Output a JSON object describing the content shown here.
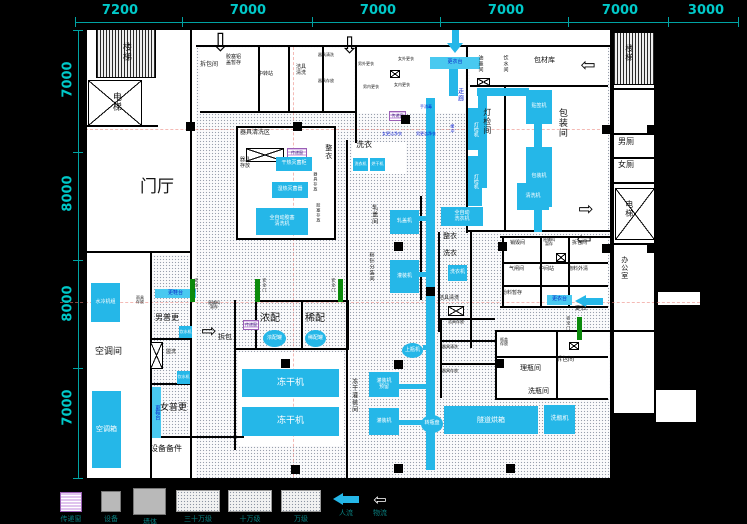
{
  "meta": {
    "app_title": "工厂洁净车间平面图",
    "drawing_type": "CAD floor plan"
  },
  "colors": {
    "background": "#000000",
    "plan": "#ffffff",
    "dimension_text": "#00c9c9",
    "equipment_fill": "#25b7e8",
    "clean_label_blue": "#0a1ed2",
    "safety_door_green": "#0b8a0b",
    "pass_window": "#e0c4ee",
    "legend_text": "#0a8080"
  },
  "dims": {
    "top": {
      "line": [
        75,
        22,
        663,
        1
      ],
      "ticks": [
        75,
        182,
        312,
        440,
        568,
        668,
        738
      ],
      "labels": [
        {
          "t": "7200",
          "x": 100
        },
        {
          "t": "7000",
          "x": 228
        },
        {
          "t": "7000",
          "x": 358
        },
        {
          "t": "7000",
          "x": 486
        },
        {
          "t": "7000",
          "x": 600
        },
        {
          "t": "3000",
          "x": 686
        }
      ]
    },
    "left": {
      "line": [
        78,
        30,
        1,
        448
      ],
      "ticks": [
        30,
        152,
        260,
        368,
        478
      ],
      "labels": [
        {
          "t": "7000",
          "y": 72
        },
        {
          "t": "8000",
          "y": 186
        },
        {
          "t": "8000",
          "y": 296
        },
        {
          "t": "7000",
          "y": 400
        }
      ]
    }
  },
  "whites": [
    [
      85,
      28,
      527,
      452
    ],
    [
      612,
      30,
      44,
      385
    ],
    [
      656,
      290,
      46,
      17
    ],
    [
      654,
      388,
      44,
      36
    ]
  ],
  "dotted": [
    [
      196,
      47,
      414,
      431
    ],
    [
      150,
      255,
      40,
      181
    ]
  ],
  "white_rooms": [
    [
      468,
      87,
      140,
      145
    ],
    [
      470,
      47,
      138,
      38
    ],
    [
      238,
      352,
      106,
      94
    ],
    [
      352,
      142,
      54,
      32
    ],
    [
      238,
      128,
      96,
      112
    ],
    [
      497,
      332,
      112,
      66
    ],
    [
      505,
      238,
      103,
      68
    ],
    [
      200,
      48,
      154,
      64
    ],
    [
      357,
      47,
      108,
      66
    ]
  ],
  "hatched": [
    [
      96,
      29,
      60,
      49
    ],
    [
      613,
      32,
      42,
      53
    ]
  ],
  "xboxes": [
    [
      88,
      80,
      54,
      46
    ],
    [
      615,
      188,
      40,
      52
    ],
    [
      246,
      148,
      38,
      14
    ],
    [
      448,
      306,
      16,
      10
    ],
    [
      477,
      78,
      13,
      8
    ],
    [
      150,
      342,
      13,
      27
    ],
    [
      556,
      253,
      10,
      9
    ],
    [
      390,
      70,
      10,
      8
    ],
    [
      569,
      342,
      10,
      8
    ]
  ],
  "walls": [
    [
      85,
      28,
      527,
      2
    ],
    [
      85,
      478,
      527,
      2
    ],
    [
      85,
      28,
      2,
      452
    ],
    [
      610,
      28,
      2,
      452
    ],
    [
      85,
      125,
      73,
      2
    ],
    [
      85,
      251,
      106,
      2
    ],
    [
      150,
      253,
      2,
      227
    ],
    [
      152,
      338,
      38,
      2
    ],
    [
      152,
      383,
      38,
      2
    ],
    [
      150,
      436,
      94,
      2
    ],
    [
      190,
      28,
      2,
      452
    ],
    [
      196,
      45,
      416,
      2
    ],
    [
      200,
      111,
      156,
      2
    ],
    [
      355,
      45,
      2,
      98
    ],
    [
      258,
      47,
      2,
      64
    ],
    [
      288,
      47,
      2,
      64
    ],
    [
      322,
      47,
      2,
      64
    ],
    [
      238,
      126,
      98,
      2
    ],
    [
      236,
      126,
      2,
      114
    ],
    [
      334,
      126,
      2,
      114
    ],
    [
      236,
      238,
      100,
      2
    ],
    [
      466,
      45,
      2,
      188
    ],
    [
      470,
      85,
      138,
      2
    ],
    [
      504,
      87,
      2,
      145
    ],
    [
      468,
      230,
      142,
      2
    ],
    [
      255,
      300,
      92,
      2
    ],
    [
      255,
      300,
      2,
      50
    ],
    [
      301,
      302,
      2,
      48
    ],
    [
      347,
      300,
      2,
      50
    ],
    [
      234,
      348,
      114,
      2
    ],
    [
      234,
      300,
      2,
      150
    ],
    [
      346,
      140,
      2,
      338
    ],
    [
      420,
      196,
      2,
      104
    ],
    [
      438,
      232,
      2,
      100
    ],
    [
      470,
      232,
      2,
      116
    ],
    [
      500,
      236,
      110,
      2
    ],
    [
      502,
      236,
      2,
      70
    ],
    [
      500,
      306,
      108,
      2
    ],
    [
      540,
      238,
      2,
      68
    ],
    [
      568,
      238,
      2,
      68
    ],
    [
      502,
      262,
      106,
      2
    ],
    [
      502,
      285,
      106,
      2
    ],
    [
      495,
      330,
      2,
      70
    ],
    [
      495,
      330,
      115,
      2
    ],
    [
      495,
      398,
      113,
      2
    ],
    [
      556,
      332,
      2,
      66
    ],
    [
      495,
      356,
      113,
      2
    ],
    [
      440,
      318,
      2,
      80
    ],
    [
      440,
      318,
      55,
      2
    ],
    [
      440,
      340,
      55,
      2
    ],
    [
      440,
      363,
      55,
      2
    ],
    [
      612,
      88,
      44,
      2
    ],
    [
      612,
      133,
      44,
      2
    ],
    [
      612,
      157,
      44,
      2
    ],
    [
      612,
      182,
      44,
      2
    ],
    [
      612,
      243,
      44,
      2
    ],
    [
      612,
      330,
      44,
      2
    ],
    [
      654,
      30,
      2,
      385
    ],
    [
      612,
      30,
      44,
      2
    ],
    [
      612,
      413,
      44,
      2
    ]
  ],
  "pipes": [
    [
      449,
      62,
      9,
      34
    ],
    [
      477,
      88,
      52,
      8
    ],
    [
      478,
      96,
      9,
      92
    ],
    [
      426,
      98,
      9,
      372
    ],
    [
      398,
      216,
      28,
      5
    ],
    [
      398,
      272,
      28,
      5
    ],
    [
      398,
      384,
      28,
      5
    ],
    [
      398,
      420,
      28,
      5
    ],
    [
      423,
      345,
      12,
      5
    ],
    [
      534,
      123,
      8,
      25
    ],
    [
      534,
      205,
      8,
      27
    ]
  ],
  "axes": [
    {
      "k": "h",
      "b": [
        85,
        129,
        525,
        0
      ]
    },
    {
      "k": "h",
      "b": [
        60,
        302,
        640,
        0
      ]
    },
    {
      "k": "v",
      "b": [
        293,
        47,
        0,
        430
      ]
    }
  ],
  "equipment": [
    {
      "t": "贴签机",
      "b": [
        526,
        90,
        26,
        34
      ]
    },
    {
      "t": "包装机",
      "b": [
        526,
        147,
        26,
        60
      ]
    },
    {
      "t": "更衣台",
      "b": [
        430,
        57,
        50,
        12
      ],
      "k": "light"
    },
    {
      "t": "干热灭菌柜",
      "b": [
        276,
        157,
        36,
        14
      ]
    },
    {
      "t": "湿热灭菌器",
      "b": [
        272,
        182,
        36,
        16
      ]
    },
    {
      "t": "全自动胶塞\n清洗机",
      "b": [
        256,
        208,
        52,
        27
      ]
    },
    {
      "t": "洗衣机",
      "b": [
        353,
        158,
        15,
        13
      ],
      "s": 4
    },
    {
      "t": "烘干机",
      "b": [
        370,
        158,
        15,
        13
      ],
      "s": 4
    },
    {
      "t": "清洗机",
      "b": [
        517,
        183,
        32,
        27
      ]
    },
    {
      "t": "全自动\n洗衣机",
      "b": [
        441,
        207,
        42,
        19
      ]
    },
    {
      "t": "洗衣机",
      "b": [
        448,
        265,
        19,
        16
      ]
    },
    {
      "t": "轧盖机",
      "b": [
        390,
        210,
        29,
        24
      ]
    },
    {
      "t": "灌装机",
      "b": [
        390,
        260,
        29,
        33
      ]
    },
    {
      "t": "冻干机",
      "b": [
        242,
        369,
        97,
        28
      ],
      "s": 9
    },
    {
      "t": "冻干机",
      "b": [
        242,
        407,
        97,
        29
      ],
      "s": 9
    },
    {
      "t": "浓配罐",
      "b": [
        263,
        330,
        23,
        17
      ],
      "k": "ellipse"
    },
    {
      "t": "稀配罐",
      "b": [
        305,
        330,
        21,
        17
      ],
      "k": "ellipse"
    },
    {
      "t": "灌装机\n预留",
      "b": [
        369,
        372,
        30,
        25
      ]
    },
    {
      "t": "灌装机",
      "b": [
        369,
        408,
        30,
        27
      ]
    },
    {
      "t": "上瓶机",
      "b": [
        402,
        343,
        21,
        15
      ],
      "k": "ellipse"
    },
    {
      "t": "转瓶盘",
      "b": [
        421,
        415,
        22,
        18
      ],
      "k": "ellipse"
    },
    {
      "t": "隧道烘箱",
      "b": [
        444,
        406,
        94,
        28
      ],
      "s": 7
    },
    {
      "t": "洗瓶机",
      "b": [
        544,
        405,
        31,
        29
      ],
      "s": 6
    },
    {
      "t": "水冷机组",
      "b": [
        91,
        283,
        29,
        39
      ]
    },
    {
      "t": "空调箱",
      "b": [
        92,
        391,
        29,
        77
      ],
      "s": 7
    },
    {
      "t": "更鞋台",
      "b": [
        155,
        289,
        41,
        9
      ],
      "k": "light"
    },
    {
      "t": "更鞋台",
      "b": [
        152,
        387,
        9,
        51
      ],
      "k": "light",
      "v": 1
    },
    {
      "t": "饮水机",
      "b": [
        179,
        326,
        13,
        12
      ],
      "s": 4
    },
    {
      "t": "饮水机",
      "b": [
        177,
        371,
        13,
        13
      ],
      "s": 4
    },
    {
      "t": "更衣台",
      "b": [
        547,
        295,
        25,
        10
      ],
      "k": "light"
    },
    {
      "t": "灯检机",
      "b": [
        468,
        108,
        14,
        42
      ],
      "v": 1
    },
    {
      "t": "灯检机",
      "b": [
        468,
        156,
        14,
        50
      ],
      "v": 1
    }
  ],
  "pass_windows": [
    {
      "t": "传递窗",
      "b": [
        389,
        111,
        17,
        10
      ]
    },
    {
      "t": "传递窗",
      "b": [
        243,
        320,
        16,
        10
      ]
    },
    {
      "t": "传递窗",
      "b": [
        287,
        148,
        20,
        10
      ]
    }
  ],
  "columns": [
    [
      186,
      122
    ],
    [
      293,
      122
    ],
    [
      401,
      115
    ],
    [
      394,
      242
    ],
    [
      498,
      242
    ],
    [
      281,
      359
    ],
    [
      394,
      360
    ],
    [
      495,
      359
    ],
    [
      291,
      465
    ],
    [
      394,
      464
    ],
    [
      506,
      464
    ],
    [
      602,
      125
    ],
    [
      647,
      125
    ],
    [
      602,
      244
    ],
    [
      647,
      244
    ],
    [
      426,
      287
    ]
  ],
  "doors": [
    [
      190,
      279
    ],
    [
      255,
      279
    ],
    [
      338,
      279
    ],
    [
      577,
      317
    ]
  ],
  "labels": [
    {
      "t": "楼梯",
      "x": 120,
      "y": 42,
      "v": 1,
      "s": 9
    },
    {
      "t": "电梯",
      "x": 110,
      "y": 92,
      "v": 1,
      "s": 9
    },
    {
      "t": "门厅",
      "x": 140,
      "y": 178,
      "s": 17
    },
    {
      "t": "空调间",
      "x": 95,
      "y": 348,
      "s": 9
    },
    {
      "t": "男普更",
      "x": 155,
      "y": 314,
      "s": 8
    },
    {
      "t": "女普更",
      "x": 160,
      "y": 404,
      "s": 9
    },
    {
      "t": "设备备件",
      "x": 150,
      "y": 445,
      "s": 8
    },
    {
      "t": "雨具\n存放",
      "x": 136,
      "y": 296,
      "s": 4
    },
    {
      "t": "盥洗",
      "x": 166,
      "y": 350,
      "s": 5
    },
    {
      "t": "拆包间",
      "x": 200,
      "y": 62,
      "s": 6
    },
    {
      "t": "胶塞铝\n盖暂存",
      "x": 226,
      "y": 55,
      "s": 5
    },
    {
      "t": "中转站",
      "x": 258,
      "y": 72,
      "s": 5
    },
    {
      "t": "洁具\n清洗",
      "x": 296,
      "y": 65,
      "s": 5
    },
    {
      "t": "器具清洗",
      "x": 318,
      "y": 53,
      "s": 4
    },
    {
      "t": "器具存放",
      "x": 318,
      "y": 79,
      "s": 4
    },
    {
      "t": "男外更衣",
      "x": 358,
      "y": 62,
      "s": 4
    },
    {
      "t": "男内更衣",
      "x": 363,
      "y": 85,
      "s": 4
    },
    {
      "t": "女外更衣",
      "x": 398,
      "y": 57,
      "s": 4
    },
    {
      "t": "女内更衣",
      "x": 394,
      "y": 83,
      "s": 4
    },
    {
      "t": "手消毒",
      "x": 420,
      "y": 105,
      "s": 4,
      "c": "blue"
    },
    {
      "t": "女更洁净衣",
      "x": 382,
      "y": 132,
      "s": 4,
      "c": "blue"
    },
    {
      "t": "男更洁净衣",
      "x": 416,
      "y": 132,
      "s": 4,
      "c": "blue"
    },
    {
      "t": "缓冲",
      "x": 450,
      "y": 124,
      "s": 4,
      "c": "blue",
      "v": 1
    },
    {
      "t": "走廊",
      "x": 456,
      "y": 88,
      "s": 6,
      "c": "blue",
      "v": 1
    },
    {
      "t": "油墨间",
      "x": 477,
      "y": 55,
      "s": 5,
      "v": 1
    },
    {
      "t": "饮水间",
      "x": 502,
      "y": 55,
      "s": 5,
      "v": 1
    },
    {
      "t": "包材库",
      "x": 534,
      "y": 57,
      "s": 7
    },
    {
      "t": "灯检间",
      "x": 482,
      "y": 108,
      "s": 8,
      "v": 1
    },
    {
      "t": "包装间",
      "x": 556,
      "y": 108,
      "s": 9,
      "v": 1
    },
    {
      "t": "器具清洗区",
      "x": 240,
      "y": 130,
      "s": 6
    },
    {
      "t": "器具\n存放",
      "x": 240,
      "y": 158,
      "s": 5
    },
    {
      "t": "整衣",
      "x": 324,
      "y": 144,
      "s": 7,
      "v": 1
    },
    {
      "t": "洗衣",
      "x": 356,
      "y": 141,
      "s": 8
    },
    {
      "t": "器具存放",
      "x": 313,
      "y": 172,
      "s": 4,
      "v": 1
    },
    {
      "t": "胶塞存放",
      "x": 316,
      "y": 203,
      "s": 4,
      "v": 1
    },
    {
      "t": "轧盖间",
      "x": 370,
      "y": 204,
      "s": 6,
      "v": 1
    },
    {
      "t": "粉针分装间",
      "x": 368,
      "y": 252,
      "s": 5,
      "v": 1
    },
    {
      "t": "整衣",
      "x": 443,
      "y": 233,
      "s": 7
    },
    {
      "t": "洗衣",
      "x": 443,
      "y": 250,
      "s": 7
    },
    {
      "t": "洁具清洗",
      "x": 439,
      "y": 296,
      "s": 5
    },
    {
      "t": "浓配",
      "x": 260,
      "y": 313,
      "s": 10
    },
    {
      "t": "稀配",
      "x": 305,
      "y": 313,
      "s": 10
    },
    {
      "t": "拆包",
      "x": 218,
      "y": 334,
      "s": 7
    },
    {
      "t": "原辅料\n暂存",
      "x": 208,
      "y": 301,
      "s": 4
    },
    {
      "t": "冻干灌装间",
      "x": 350,
      "y": 378,
      "s": 6,
      "v": 1
    },
    {
      "t": "销毁间",
      "x": 510,
      "y": 241,
      "s": 5
    },
    {
      "t": "原辅料\n暂存",
      "x": 543,
      "y": 238,
      "s": 4
    },
    {
      "t": "拆包间",
      "x": 572,
      "y": 241,
      "s": 5
    },
    {
      "t": "气闸间",
      "x": 509,
      "y": 267,
      "s": 5
    },
    {
      "t": "中间站",
      "x": 539,
      "y": 267,
      "s": 5
    },
    {
      "t": "物料外清",
      "x": 568,
      "y": 267,
      "s": 5
    },
    {
      "t": "粉料暂存",
      "x": 502,
      "y": 291,
      "s": 5
    },
    {
      "t": "更衣",
      "x": 575,
      "y": 306,
      "s": 6
    },
    {
      "t": "洁具存放",
      "x": 448,
      "y": 320,
      "s": 4
    },
    {
      "t": "器具清洗",
      "x": 442,
      "y": 345,
      "s": 4
    },
    {
      "t": "器具存放",
      "x": 442,
      "y": 369,
      "s": 4
    },
    {
      "t": "瓶盖\n存放",
      "x": 500,
      "y": 338,
      "s": 4
    },
    {
      "t": "理瓶间",
      "x": 520,
      "y": 365,
      "s": 7
    },
    {
      "t": "拆包间",
      "x": 556,
      "y": 357,
      "s": 6
    },
    {
      "t": "洗瓶间",
      "x": 528,
      "y": 388,
      "s": 7
    },
    {
      "t": "男厕",
      "x": 618,
      "y": 138,
      "s": 8
    },
    {
      "t": "女厕",
      "x": 618,
      "y": 161,
      "s": 8
    },
    {
      "t": "电梯",
      "x": 624,
      "y": 200,
      "s": 8,
      "v": 1
    },
    {
      "t": "办公室",
      "x": 620,
      "y": 256,
      "s": 7,
      "v": 1
    },
    {
      "t": "楼梯",
      "x": 624,
      "y": 44,
      "s": 8,
      "v": 1
    },
    {
      "t": "安全门",
      "x": 194,
      "y": 278,
      "s": 4,
      "v": 1
    },
    {
      "t": "安全门",
      "x": 262,
      "y": 278,
      "s": 4,
      "v": 1
    },
    {
      "t": "安全门",
      "x": 331,
      "y": 278,
      "s": 4,
      "v": 1
    },
    {
      "t": "安全门",
      "x": 566,
      "y": 316,
      "s": 4,
      "v": 1
    }
  ],
  "arrows": [
    {
      "k": "cyan",
      "d": "down",
      "b": [
        447,
        30,
        17,
        24
      ]
    },
    {
      "k": "cyan",
      "d": "left",
      "b": [
        575,
        295,
        28,
        13
      ]
    },
    {
      "k": "white",
      "d": "down",
      "b": [
        210,
        32,
        18,
        22
      ]
    },
    {
      "k": "white",
      "d": "down",
      "b": [
        340,
        36,
        16,
        20
      ]
    },
    {
      "k": "white",
      "d": "left",
      "b": [
        578,
        58,
        20,
        15
      ]
    },
    {
      "k": "white",
      "d": "right",
      "b": [
        576,
        202,
        20,
        15
      ]
    },
    {
      "k": "white",
      "d": "left",
      "b": [
        574,
        232,
        20,
        15
      ]
    },
    {
      "k": "white",
      "d": "right",
      "b": [
        199,
        324,
        20,
        15
      ]
    }
  ],
  "legend": {
    "items": [
      {
        "kind": "pass",
        "label": "传递窗",
        "b": [
          60,
          492,
          22,
          20
        ]
      },
      {
        "kind": "gray",
        "label": "设备",
        "b": [
          101,
          491,
          20,
          21
        ]
      },
      {
        "kind": "gray",
        "label": "墙体",
        "b": [
          133,
          488,
          33,
          27
        ]
      },
      {
        "kind": "dot",
        "label": "三十万级",
        "b": [
          176,
          490,
          44,
          22
        ]
      },
      {
        "kind": "dot",
        "label": "十万级",
        "b": [
          228,
          490,
          44,
          22
        ]
      },
      {
        "kind": "dot",
        "label": "万级",
        "b": [
          281,
          490,
          40,
          22
        ]
      },
      {
        "kind": "arrow-cyan",
        "label": "人流",
        "b": [
          333,
          493,
          26,
          13
        ]
      },
      {
        "kind": "arrow-white",
        "label": "物流",
        "b": [
          368,
          493,
          24,
          13
        ]
      }
    ]
  }
}
